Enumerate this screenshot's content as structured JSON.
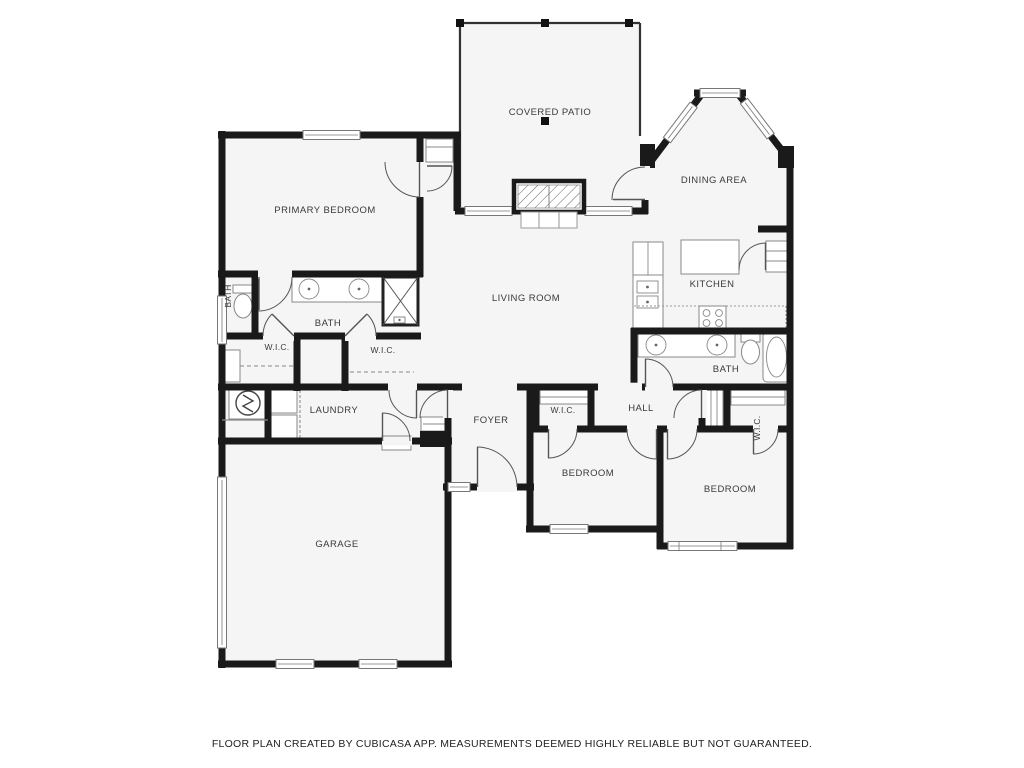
{
  "floor_plan": {
    "attribution": "FLOOR PLAN CREATED BY CUBICASA APP. MEASUREMENTS DEEMED HIGHLY RELIABLE BUT NOT GUARANTEED.",
    "rooms": {
      "covered_patio": {
        "label": "COVERED PATIO"
      },
      "dining_area": {
        "label": "DINING AREA"
      },
      "primary_bedroom": {
        "label": "PRIMARY BEDROOM"
      },
      "living_room": {
        "label": "LIVING ROOM"
      },
      "kitchen": {
        "label": "KITCHEN"
      },
      "bath_hall": {
        "label": "BATH"
      },
      "bath_primary": {
        "label": "BATH"
      },
      "bath_wc": {
        "label": "BATH"
      },
      "wic_primary_left": {
        "label": "W.I.C."
      },
      "wic_primary_right": {
        "label": "W.I.C."
      },
      "laundry": {
        "label": "LAUNDRY"
      },
      "foyer": {
        "label": "FOYER"
      },
      "wic_hall": {
        "label": "W.I.C."
      },
      "hall": {
        "label": "HALL"
      },
      "wic_bedroom_right": {
        "label": "W.I.C."
      },
      "bedroom_left": {
        "label": "BEDROOM"
      },
      "bedroom_right": {
        "label": "BEDROOM"
      },
      "garage": {
        "label": "GARAGE"
      }
    },
    "colors": {
      "wall": "#1a1a1a",
      "room_fill": "#f5f5f5",
      "background": "#ffffff",
      "label_text": "#3a3a3a"
    }
  }
}
